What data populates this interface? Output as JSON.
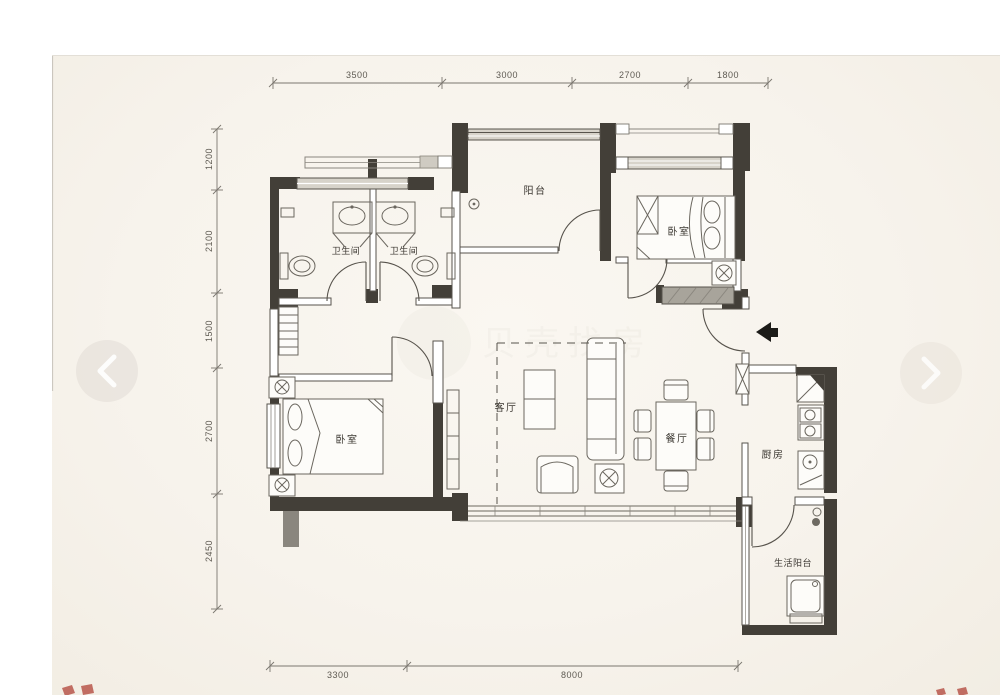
{
  "viewer": {
    "page_background": "#ffffff",
    "photo_background": "#f7f3ec",
    "nav": {
      "prev_icon": "chevron-left",
      "next_icon": "chevron-right"
    },
    "red_fragment_color": "#b2493d"
  },
  "floorplan": {
    "watermark_text": "贝壳找房",
    "colors": {
      "wall": "#433f38",
      "line": "#57534c",
      "dimension": "#5e5a52",
      "label": "#3b3731"
    },
    "rooms": {
      "balcony": "阳台",
      "bathroom_left": "卫生间",
      "bathroom_right": "卫生间",
      "bedroom_top_right": "卧室",
      "living_room": "客厅",
      "dining_room": "餐厅",
      "kitchen": "厨房",
      "bedroom_bottom_left": "卧室",
      "service_balcony": "生活阳台"
    },
    "dimensions": {
      "top": [
        "3500",
        "3000",
        "2700",
        "1800"
      ],
      "left": [
        "1200",
        "2100",
        "1500",
        "2700",
        "2450"
      ],
      "bottom": [
        "3300",
        "8000"
      ]
    }
  }
}
